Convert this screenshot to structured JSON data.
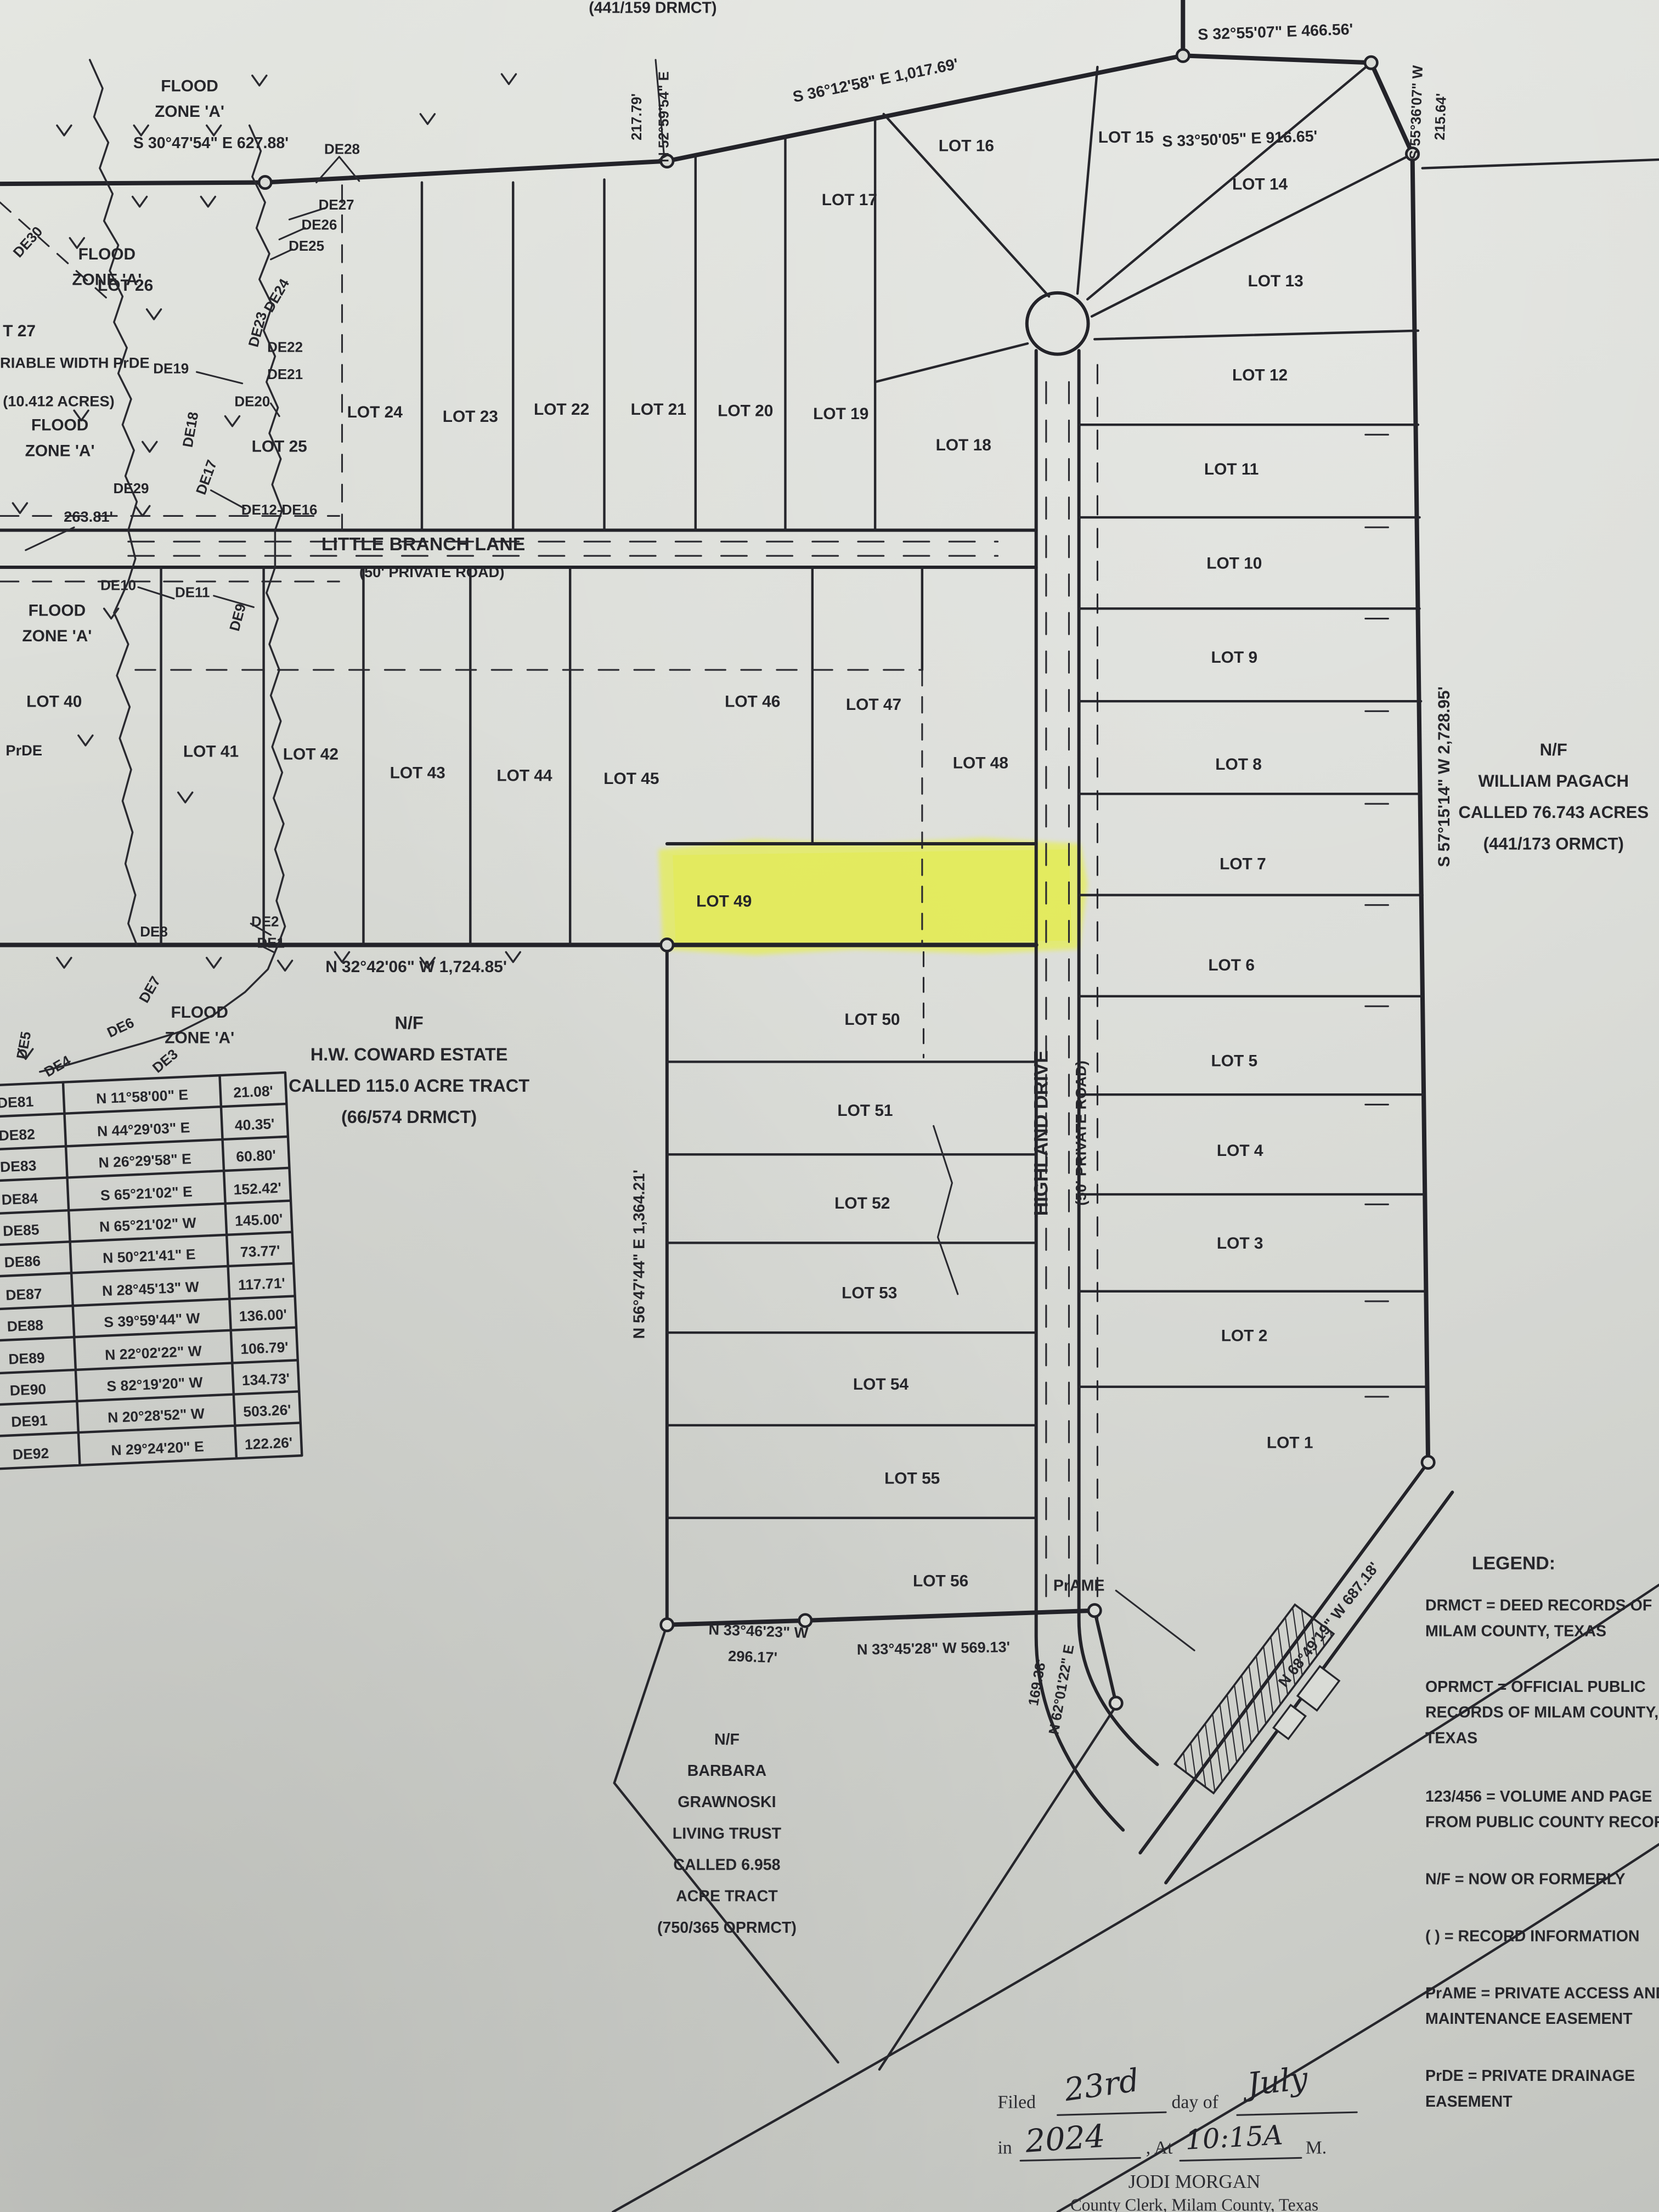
{
  "doc": {
    "top_partial": "(441/159 DRMCT)"
  },
  "bearing": {
    "b1": "S 30°47'54\" E 627.88'",
    "b2": "S 33°50'05\" E 916.65'",
    "b3": "S 36°12'58\" E 1,017.69'",
    "b4": "S 32°55'07\" E 466.56'",
    "b5": "N 52°59'54\" E",
    "b5d": "217.79'",
    "b6": "S 55°36'07\" W",
    "b6d": "215.64'",
    "b7": "S 57°15'14\" W 2,728.95'",
    "b8": "N 32°42'06\" W 1,724.85'",
    "b9": "N 56°47'44\" E 1,364.21'",
    "b10": "N 33°46'23\" W",
    "b10d": "296.17'",
    "b11": "N 33°45'28\" W 569.13'",
    "b12": "N 62°01'22\" E",
    "b12d": "169.38'",
    "b13": "N 68°49'19\" W 687.18'",
    "d263": "263.81'"
  },
  "roads": {
    "lbl": "LITTLE BRANCH LANE",
    "lbl_sub": "(50' PRIVATE ROAD)",
    "hd": "HIGHLAND DRIVE",
    "hd_sub": "(50' PRIVATE ROAD)"
  },
  "flood": {
    "f1": "FLOOD",
    "f2": "ZONE 'A'"
  },
  "easement": {
    "prde": "PrDE",
    "prame": "PrAME",
    "var1": "RIABLE WIDTH PrDE",
    "var2": "(10.412 ACRES)"
  },
  "lots": {
    "l1": "LOT 1",
    "l2": "LOT 2",
    "l3": "LOT 3",
    "l4": "LOT 4",
    "l5": "LOT 5",
    "l6": "LOT 6",
    "l7": "LOT 7",
    "l8": "LOT 8",
    "l9": "LOT 9",
    "l10": "LOT 10",
    "l11": "LOT 11",
    "l12": "LOT 12",
    "l13": "LOT 13",
    "l14": "LOT 14",
    "l15": "LOT 15",
    "l16": "LOT 16",
    "l17": "LOT 17",
    "l18": "LOT 18",
    "l19": "LOT 19",
    "l20": "LOT 20",
    "l21": "LOT 21",
    "l22": "LOT 22",
    "l23": "LOT 23",
    "l24": "LOT 24",
    "l25": "LOT 25",
    "l26": "LOT 26",
    "l27p": "T 27",
    "l40": "LOT 40",
    "l41": "LOT 41",
    "l42": "LOT 42",
    "l43": "LOT 43",
    "l44": "LOT 44",
    "l45": "LOT 45",
    "l46": "LOT 46",
    "l47": "LOT 47",
    "l48": "LOT 48",
    "l49": "LOT 49",
    "l50": "LOT 50",
    "l51": "LOT 51",
    "l52": "LOT 52",
    "l53": "LOT 53",
    "l54": "LOT 54",
    "l55": "LOT 55",
    "l56": "LOT 56"
  },
  "owners": {
    "nf": "N/F",
    "pagach": [
      "WILLIAM PAGACH",
      "CALLED 76.743 ACRES",
      "(441/173 ORMCT)"
    ],
    "coward": [
      "H.W. COWARD ESTATE",
      "CALLED 115.0 ACRE TRACT",
      "(66/574 DRMCT)"
    ],
    "grawnoski": [
      "BARBARA",
      "GRAWNOSKI",
      "LIVING TRUST",
      "CALLED 6.958",
      "ACRE TRACT",
      "(750/365 OPRMCT)"
    ]
  },
  "de": {
    "d1": "DE1",
    "d2": "DE2",
    "d3": "DE3",
    "d4": "DE4",
    "d5": "DE5",
    "d6": "DE6",
    "d7": "DE7",
    "d8": "DE8",
    "d9": "DE9",
    "d10": "DE10",
    "d11": "DE11",
    "d12_16": "DE12-DE16",
    "d17": "DE17",
    "d18": "DE18",
    "d19": "DE19",
    "d20": "DE20",
    "d21": "DE21",
    "d22": "DE22",
    "d23": "DE23",
    "d24": "DE24",
    "d25": "DE25",
    "d26": "DE26",
    "d27": "DE27",
    "d28": "DE28",
    "d29": "DE29",
    "d30": "DE30"
  },
  "table": {
    "rows": [
      [
        "DE81",
        "N 11°58'00\" E",
        "21.08'"
      ],
      [
        "DE82",
        "N 44°29'03\" E",
        "40.35'"
      ],
      [
        "DE83",
        "N 26°29'58\" E",
        "60.80'"
      ],
      [
        "DE84",
        "S 65°21'02\" E",
        "152.42'"
      ],
      [
        "DE85",
        "N 65°21'02\" W",
        "145.00'"
      ],
      [
        "DE86",
        "N 50°21'41\" E",
        "73.77'"
      ],
      [
        "DE87",
        "N 28°45'13\" W",
        "117.71'"
      ],
      [
        "DE88",
        "S 39°59'44\" W",
        "136.00'"
      ],
      [
        "DE89",
        "N 22°02'22\" W",
        "106.79'"
      ],
      [
        "DE90",
        "S 82°19'20\" W",
        "134.73'"
      ],
      [
        "DE91",
        "N 20°28'52\" W",
        "503.26'"
      ],
      [
        "DE92",
        "N 29°24'20\" E",
        "122.26'"
      ]
    ]
  },
  "legend": {
    "title": "LEGEND:",
    "i1a": "DRMCT = DEED RECORDS OF",
    "i1b": "MILAM COUNTY, TEXAS",
    "i2a": "OPRMCT = OFFICIAL PUBLIC",
    "i2b": "RECORDS OF MILAM COUNTY,",
    "i2c": "TEXAS",
    "i3a": "123/456 = VOLUME AND PAGE",
    "i3b": "FROM PUBLIC COUNTY RECORDS",
    "i4": "N/F = NOW OR FORMERLY",
    "i5": "( ) = RECORD INFORMATION",
    "i6a": "PrAME = PRIVATE ACCESS AND",
    "i6b": "MAINTENANCE EASEMENT",
    "i7a": "PrDE = PRIVATE DRAINAGE",
    "i7b": "EASEMENT"
  },
  "filing": {
    "filed": "Filed",
    "day": "23rd",
    "day_of": "day of",
    "month": "July",
    "in_word": "in",
    "year": "2024",
    "at_word": ", At",
    "time": "10:15A",
    "m": "M.",
    "clerk_name": "JODI MORGAN",
    "clerk_title": "County Clerk, Milam County, Texas"
  },
  "highlight_color": "#e7f138"
}
